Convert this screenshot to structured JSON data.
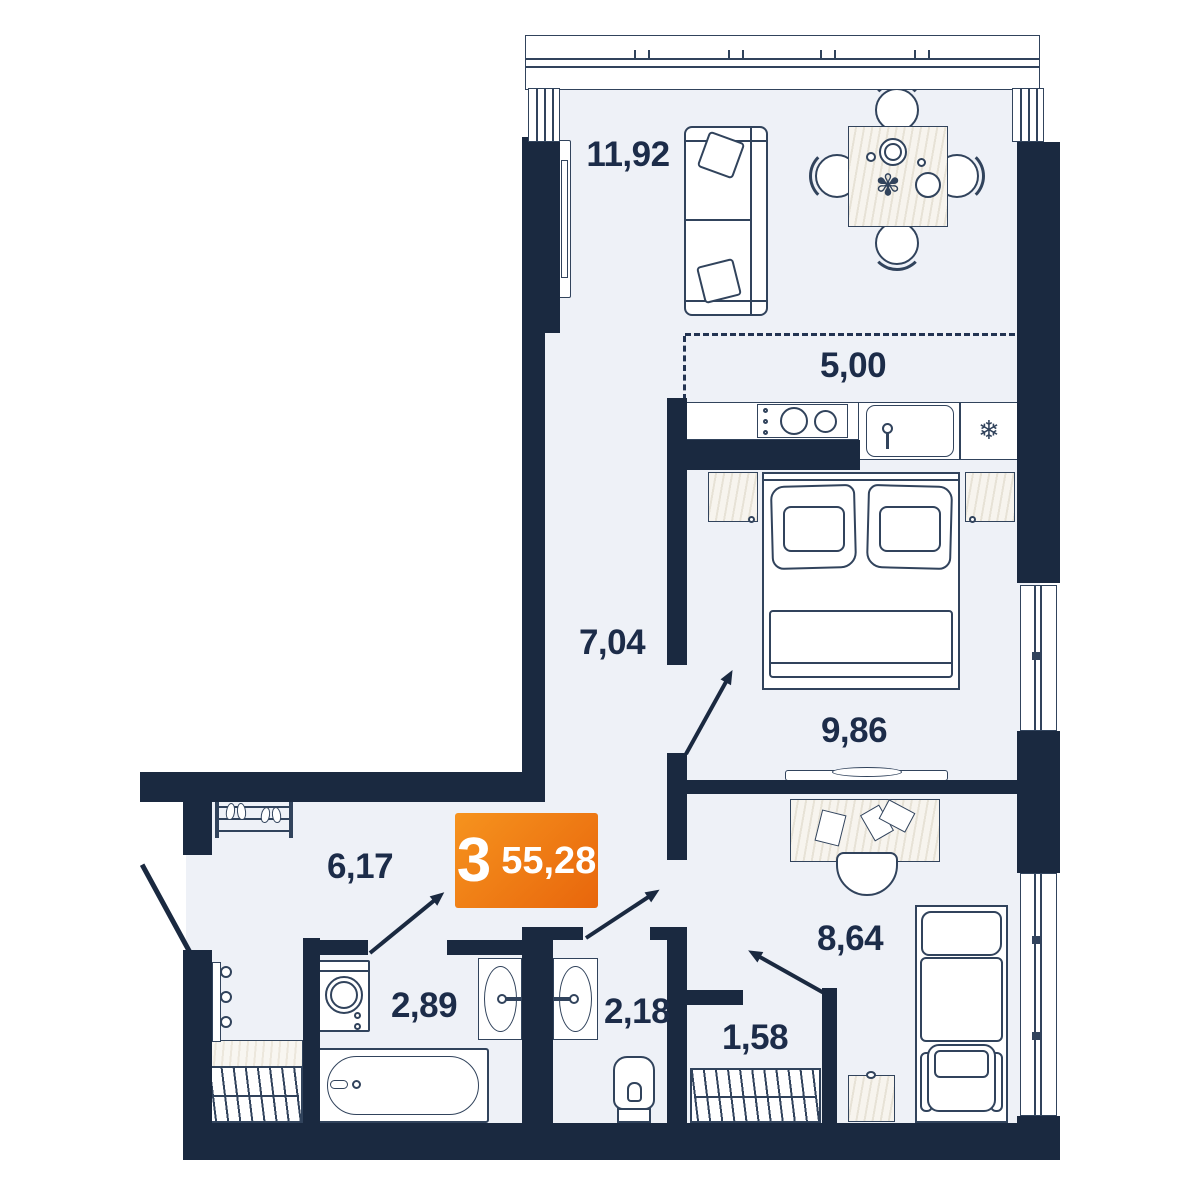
{
  "badge": {
    "rooms_count": "3",
    "total_area": "55,28"
  },
  "rooms": {
    "living": {
      "label": "11,92"
    },
    "kitchen": {
      "label": "5,00"
    },
    "hall": {
      "label": "7,04"
    },
    "bedroom_main": {
      "label": "9,86"
    },
    "entry": {
      "label": "6,17"
    },
    "bathroom": {
      "label": "2,89"
    },
    "wc": {
      "label": "2,18"
    },
    "closet": {
      "label": "1,58"
    },
    "bedroom_second": {
      "label": "8,64"
    }
  },
  "icons": {
    "fridge_snowflake": "❄",
    "table_plant": "✾"
  },
  "colors": {
    "wall": "#1a2940",
    "floor": "#eef1f7",
    "line": "#31435c",
    "badge_gradient_from": "#f6931e",
    "badge_gradient_to": "#e8660c",
    "badge_text": "#ffffff"
  }
}
